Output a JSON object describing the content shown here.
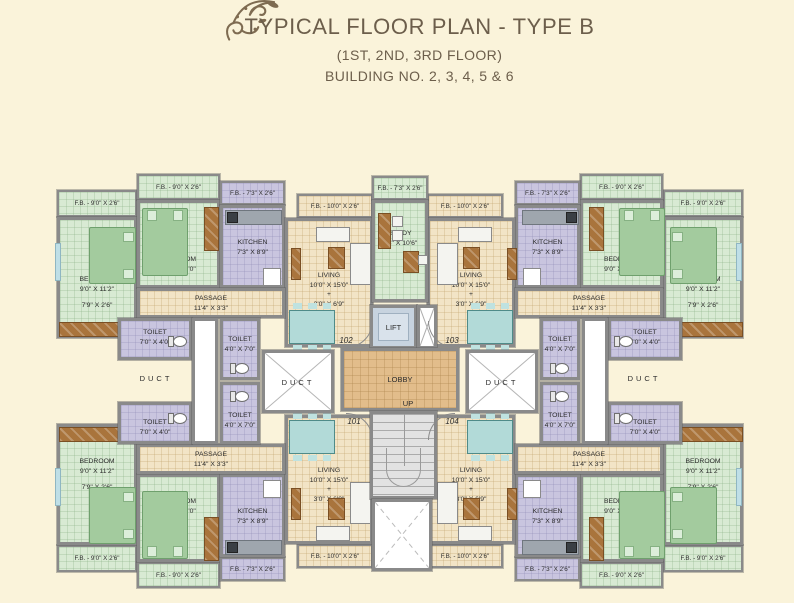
{
  "title": {
    "main": "TYPICAL FLOOR PLAN - TYPE B",
    "line2": "(1ST, 2ND, 3RD FLOOR)",
    "line3": "BUILDING NO. 2, 3, 4, 5 & 6"
  },
  "labels": {
    "fb_90": "F.B. - 9'0\" X 2'6\"",
    "fb_73": "F.B. - 7'3\" X 2'6\"",
    "fb_100": "F.B. - 10'0\" X 2'6\"",
    "bedroom": "BEDROOM",
    "bedroom_large": "9'0\" X 11'2\"",
    "bedroom_large2": "7'9\" X 2'6\"",
    "bedroom_small": "9'0\" X 10'0\"",
    "kitchen": "KITCHEN",
    "kitchen_size": "7'3\" X 8'9\"",
    "living": "LIVING",
    "living_size": "10'0\" X 15'0\"",
    "plus": "+",
    "living_size2": "3'0\" X 6'9\"",
    "passage": "PASSAGE",
    "passage_size": "11'4\" X 3'3\"",
    "toilet": "TOILET",
    "toilet_h": "7'0\" X 4'0\"",
    "toilet_v": "4'0\" X 7'0\"",
    "study": "STUDY",
    "study_size": "7'3\" X 10'6\"",
    "lift": "LIFT",
    "lobby": "LOBBY",
    "up": "UP",
    "duct": "DUCT"
  },
  "units": {
    "u101": "101",
    "u102": "102",
    "u103": "103",
    "u104": "104"
  },
  "colors": {
    "background": "#FAF3DA",
    "bedroom_fill": "#D8EAD3",
    "kitchen_toilet_fill": "#C9C5DF",
    "living_fill": "#F2E4C6",
    "lobby_fill": "#E2BD8B",
    "lift_fill": "#C7D3DF",
    "wall": "#8A8A8A",
    "wood": "#A9743C",
    "bed": "#A3CB9E",
    "dining_table": "#B2DAD8",
    "title_text": "#6C5E4B"
  }
}
